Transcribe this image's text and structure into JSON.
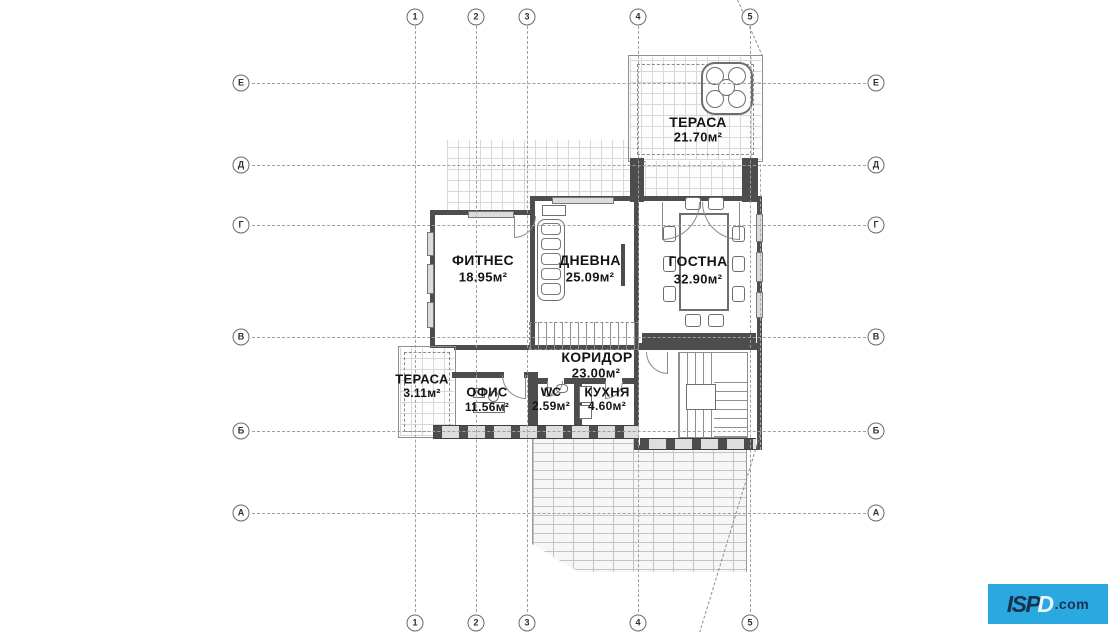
{
  "page": {
    "background": "#ffffff"
  },
  "grid": {
    "columns": [
      "1",
      "2",
      "3",
      "4",
      "5"
    ],
    "rows": [
      "Е",
      "Д",
      "Г",
      "В",
      "Б",
      "А"
    ]
  },
  "rooms": {
    "terrace_top": {
      "name": "ТЕРАСА",
      "area": "21.70м²"
    },
    "fitness": {
      "name": "ФИТНЕС",
      "area": "18.95м²"
    },
    "dnevna": {
      "name": "ДНЕВНА",
      "area": "25.09м²"
    },
    "gostna": {
      "name": "ГОСТНА",
      "area": "32.90м²"
    },
    "koridor": {
      "name": "КОРИДОР",
      "area": "23.00м²"
    },
    "terrace_left": {
      "name": "ТЕРАСА",
      "area": "3.11м²"
    },
    "ofis": {
      "name": "ОФИС",
      "area": "11.56м²"
    },
    "wc": {
      "name": "WC",
      "area": "2.59м²"
    },
    "kuhnya": {
      "name": "КУХНЯ",
      "area": "4.60м²"
    }
  },
  "watermark": {
    "prefix": "ISP",
    "d": "D",
    "suffix": ".com",
    "bg": "#29a9e0",
    "fg": "#17324d"
  },
  "icons": {
    "hot-tub-icon": "octagonal spa with round tub",
    "sofa-icon": "sectional sofa with cushions",
    "dining-table-icon": "rectangular table with ten chairs",
    "stairs-icon": "tread hatching",
    "desk-icon": "office desk with chair",
    "sink-icon": "round basin",
    "logo-icon": "blue ISPD.com badge"
  },
  "colors": {
    "wall": "#4d4d4d",
    "grid_line": "#9e9e9e",
    "tile_line": "#d8d8d8",
    "brick_line": "#c3c3c3",
    "text": "#141414"
  }
}
